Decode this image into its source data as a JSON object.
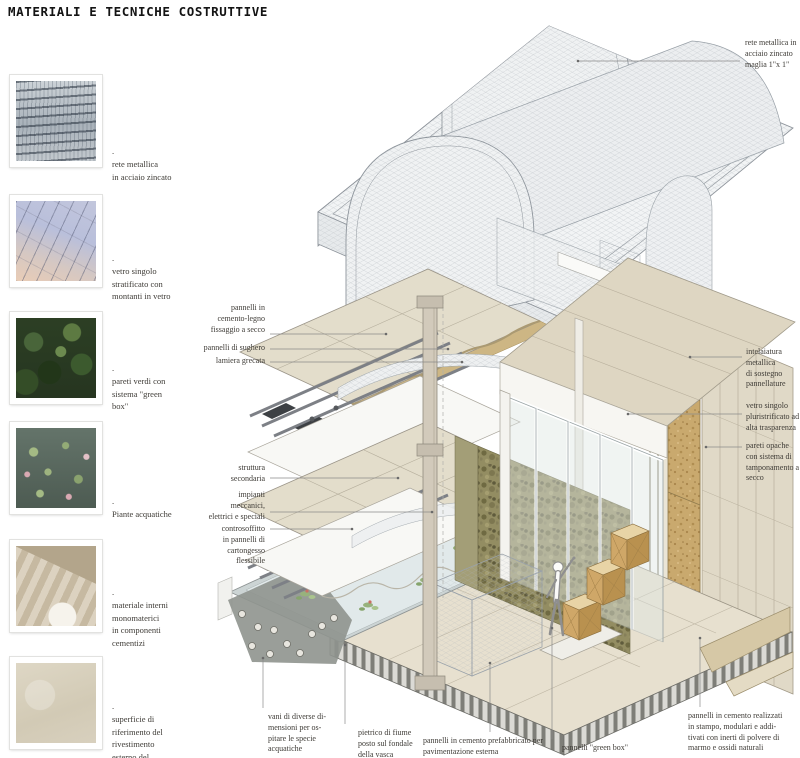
{
  "title": "MATERIALI E TECNICHE COSTRUTTIVE",
  "legend": {
    "items": [
      {
        "photo": "metal-mesh",
        "caption": ".\nrete metallica\nin acciaio zincato"
      },
      {
        "photo": "glass-facade",
        "caption": ".\nvetro singolo\nstratificato con\nmontanti in vetro"
      },
      {
        "photo": "green-wall",
        "caption": ".\npareti verdi con\nsistema \"green\nbox\""
      },
      {
        "photo": "water-lilies",
        "caption": ".\nPiante acquatiche"
      },
      {
        "photo": "concrete-stairs",
        "caption": ".\nmateriale interni\nmonomaterici\nin componenti\ncementizi"
      },
      {
        "photo": "concrete-surface",
        "caption": ".\nsuperficie di\nriferimento del\nrivestimento\nesterno del\npadiglione"
      }
    ]
  },
  "callouts": {
    "rete": "rete metallica in\nacciaio zincato\nmaglia 1\"x 1\"",
    "cemento_legno": "pannelli in\ncemento-legno\nfissaggio a secco",
    "sughero": "pannelli di sughero",
    "lamiera": "lamiera grecata",
    "struttura": "struttura\nsecondaria",
    "impianti": "impianti\nmeccanici,\nelettrici e speciali",
    "controsoffitto": "controsoffitto\nin pannelli di\ncartongesso\nflessibile",
    "intelaiatura": "intelaiatura\nmetallica\ndi sostegno\npannellature",
    "vetro": "vetro singolo\npluristrificato ad\nalta trasparenza",
    "pareti_opache": "pareti opache\ncon sistema di\ntamponamento a\nsecco",
    "vani": "vani di diverse di-\nmensioni per os-\npitare le specie\nacquatiche",
    "pietrisco": "pietrico di fiume\nposto sul fondale\ndella vasca",
    "pavimentazione": "pannelli in cemento prefabbricato per\npavimentazione esterna",
    "green_box": "pannelli \"green box\"",
    "cemento_stampo": "pannelli in cemento realizzati\nin stampo, modulari e addi-\ntivati con inerti di polvere di\nmarmo e ossidi naturali"
  },
  "colors": {
    "mesh_line": "#aeb4ba",
    "beige_panel": "#e3ddcb",
    "cork": "#c9a96e",
    "green_wall": "#938d62",
    "water": "#e1e9ea",
    "wood": "#cfa768",
    "ink": "#3e3b36"
  }
}
